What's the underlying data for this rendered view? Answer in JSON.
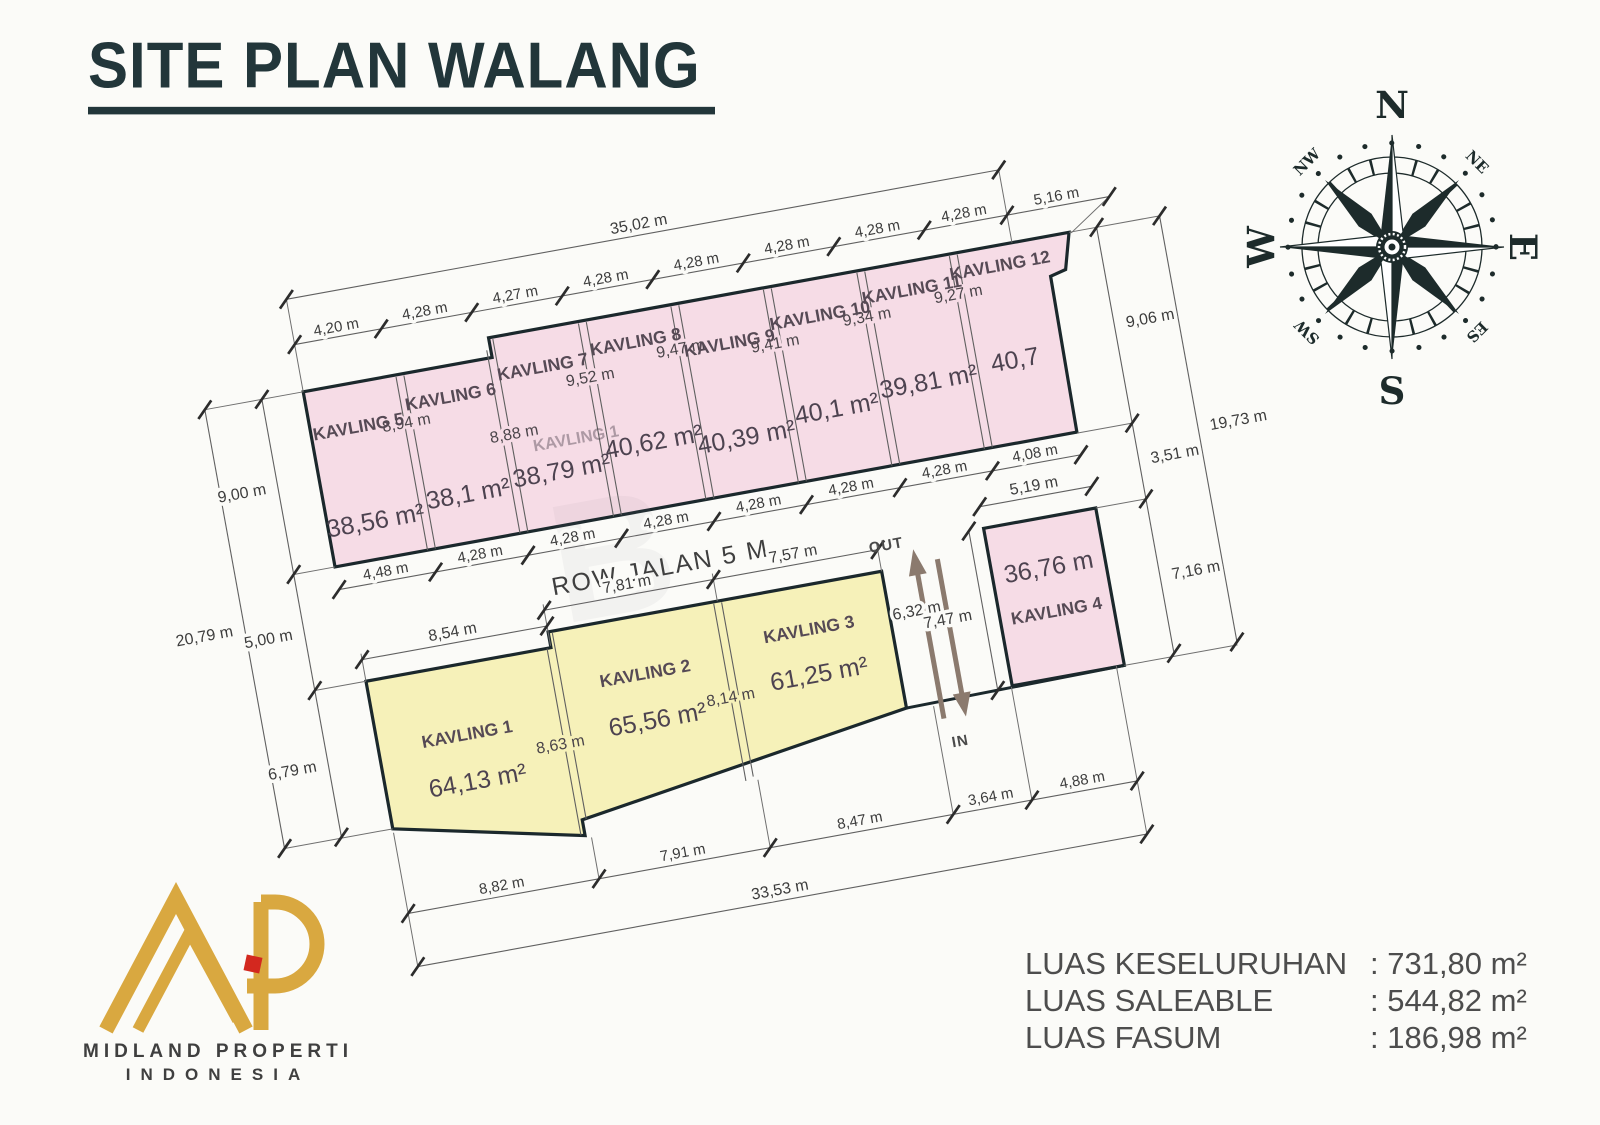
{
  "title": "SITE PLAN WALANG",
  "compass": {
    "n": "N",
    "s": "S",
    "e": "E",
    "w": "W",
    "ne": "NE",
    "nw": "NW",
    "sw": "SW",
    "es": "ES"
  },
  "plan": {
    "road_label": "ROW JALAN 5 M",
    "out_label": "OUT",
    "in_label": "IN",
    "watermark": "B",
    "ghost_label": "KAVLING 1",
    "dims": {
      "top_overall": "35,02 m",
      "top_segments": [
        "4,20 m",
        "4,28 m",
        "4,27 m",
        "4,28 m",
        "4,28 m",
        "4,28 m",
        "4,28 m",
        "4,28 m",
        "5,16 m"
      ],
      "pink_bottom_segments": [
        "4,48 m",
        "4,28 m",
        "4,28 m",
        "4,28 m",
        "4,28 m",
        "4,28 m",
        "4,28 m",
        "4,08 m"
      ],
      "left_segments": [
        "9,00 m",
        "5,00 m",
        "6,79 m"
      ],
      "left_overall": "20,79 m",
      "right_segments": [
        "9,06 m",
        "3,51 m",
        "7,16 m"
      ],
      "right_overall": "19,73 m",
      "bottom_segments": [
        "8,82 m",
        "7,91 m",
        "8,47 m",
        "3,64 m",
        "4,88 m"
      ],
      "bottom_overall": "33,53 m"
    },
    "pink_plots": [
      {
        "name": "KAVLING 5",
        "depth": "8,94 m",
        "area": "38,56 m²"
      },
      {
        "name": "KAVLING 6",
        "depth": "8,88 m",
        "area": "38,1 m²"
      },
      {
        "name": "KAVLING 7",
        "depth": "9,52 m",
        "area": "38,79 m²"
      },
      {
        "name": "KAVLING 8",
        "depth": "9,47 m",
        "area": "40,62 m²"
      },
      {
        "name": "KAVLING 9",
        "depth": "9,41 m",
        "area": "40,39 m²"
      },
      {
        "name": "KAVLING 10",
        "depth": "9,34 m",
        "area": "40,1 m²"
      },
      {
        "name": "KAVLING 11",
        "depth": "9,27 m",
        "area": "39,81 m²"
      },
      {
        "name": "KAVLING 12",
        "area": "40,7"
      }
    ],
    "yellow_plots": [
      {
        "name": "KAVLING 1",
        "area": "64,13 m²",
        "front": "8,54 m"
      },
      {
        "name": "KAVLING 2",
        "area": "65,56 m²",
        "front": "7,81 m",
        "side": "8,63 m"
      },
      {
        "name": "KAVLING 3",
        "area": "61,25 m²",
        "front": "7,57 m",
        "side": "8,14 m",
        "right_side": "6,32 m"
      }
    ],
    "plot4": {
      "name": "KAVLING 4",
      "area": "36,76 m",
      "front": "5,19 m",
      "side": "7,47 m"
    }
  },
  "logo": {
    "name": "MIDLAND PROPERTI",
    "sub": "INDONESIA"
  },
  "summary": [
    {
      "label": "LUAS KESELURUHAN",
      "value": ": 731,80 m²"
    },
    {
      "label": "LUAS SALEABLE",
      "value": ": 544,82 m²"
    },
    {
      "label": "LUAS FASUM",
      "value": ": 186,98 m²"
    }
  ]
}
